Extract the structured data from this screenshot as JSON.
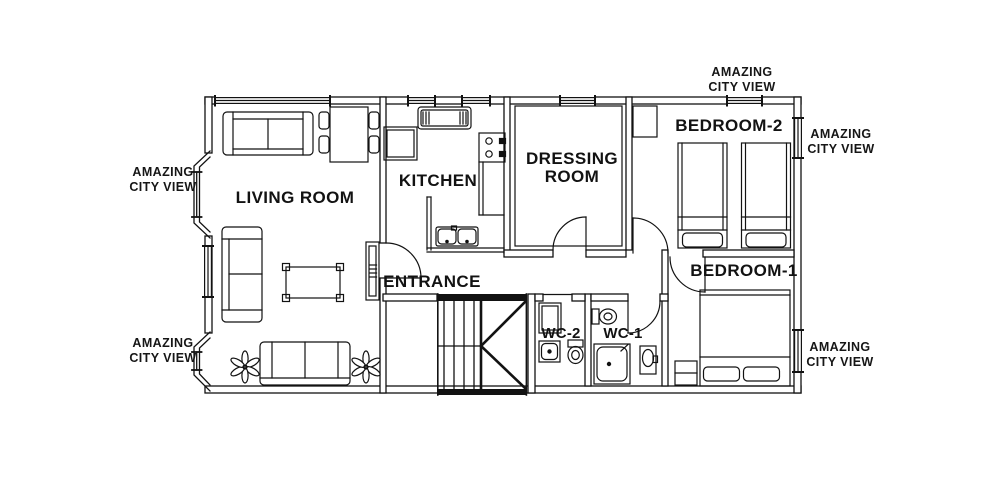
{
  "colors": {
    "ink": "#121212",
    "background": "#ffffff"
  },
  "rooms": {
    "living_room": "LIVING ROOM",
    "kitchen": "KITCHEN",
    "dressing_room_line1": "DRESSING",
    "dressing_room_line2": "ROOM",
    "bedroom_2": "BEDROOM-2",
    "bedroom_1": "BEDROOM-1",
    "entrance": "ENTRANCE",
    "wc_2": "WC-2",
    "wc_1": "WC-1"
  },
  "view_labels": [
    {
      "placement": "left-upper",
      "line1": "AMAZING",
      "line2": "CITY VIEW"
    },
    {
      "placement": "left-lower",
      "line1": "AMAZING",
      "line2": "CITY VIEW"
    },
    {
      "placement": "top-right",
      "line1": "AMAZING",
      "line2": "CITY VIEW"
    },
    {
      "placement": "right-upper",
      "line1": "AMAZING",
      "line2": "CITY VIEW"
    },
    {
      "placement": "right-lower",
      "line1": "AMAZING",
      "line2": "CITY VIEW"
    }
  ]
}
